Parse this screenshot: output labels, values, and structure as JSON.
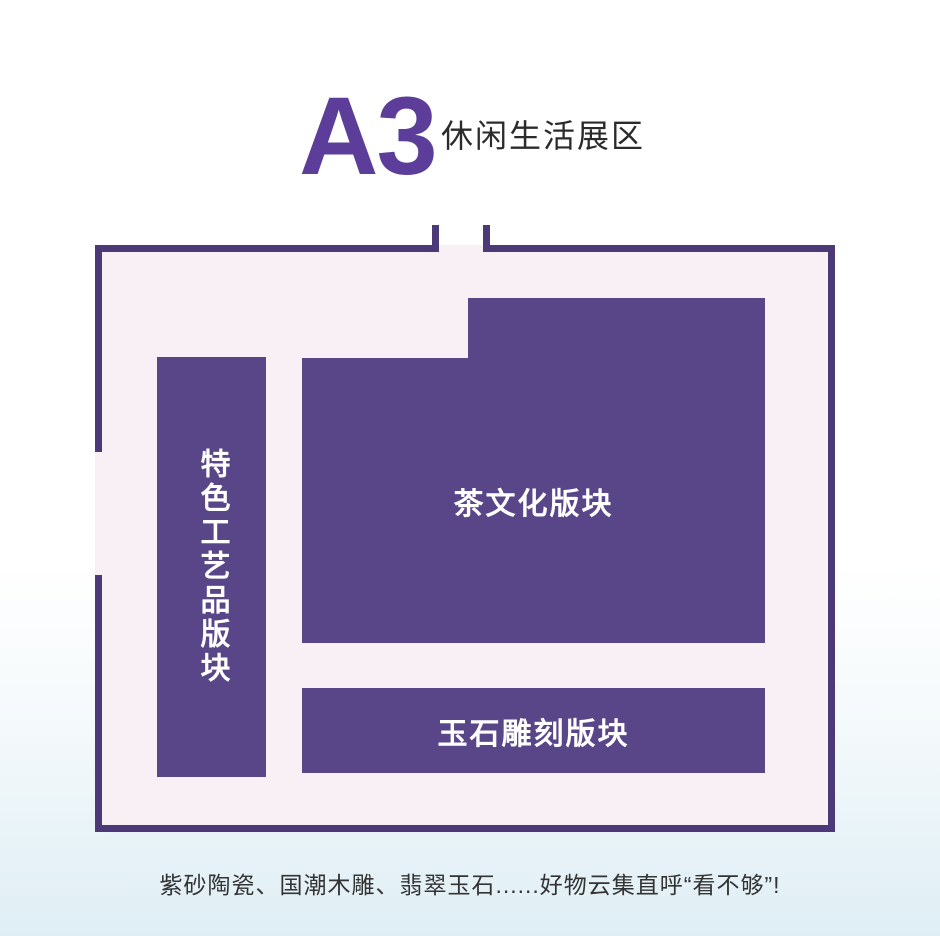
{
  "page": {
    "background_top": "#ffffff",
    "background_bottom": "#dfeef5"
  },
  "header": {
    "zone_code": "A3",
    "zone_name": "休闲生活展区"
  },
  "floorplan": {
    "type": "exhibition-hall-map",
    "entrance": "gap in top wall flanked by two door jambs",
    "colors": {
      "accent": "#5c3d99",
      "wall": "#4c3a78",
      "floor": "#f9f0f6",
      "block": "#594689",
      "label_text": "#ffffff"
    },
    "sections": [
      {
        "id": "crafts",
        "label": "特色工艺品版块",
        "orientation": "vertical"
      },
      {
        "id": "tea",
        "label": "茶文化版块",
        "orientation": "horizontal"
      },
      {
        "id": "jade",
        "label": "玉石雕刻版块",
        "orientation": "horizontal"
      }
    ]
  },
  "caption": {
    "text": "紫砂陶瓷、国潮木雕、翡翠玉石......好物云集直呼“看不够”!"
  }
}
